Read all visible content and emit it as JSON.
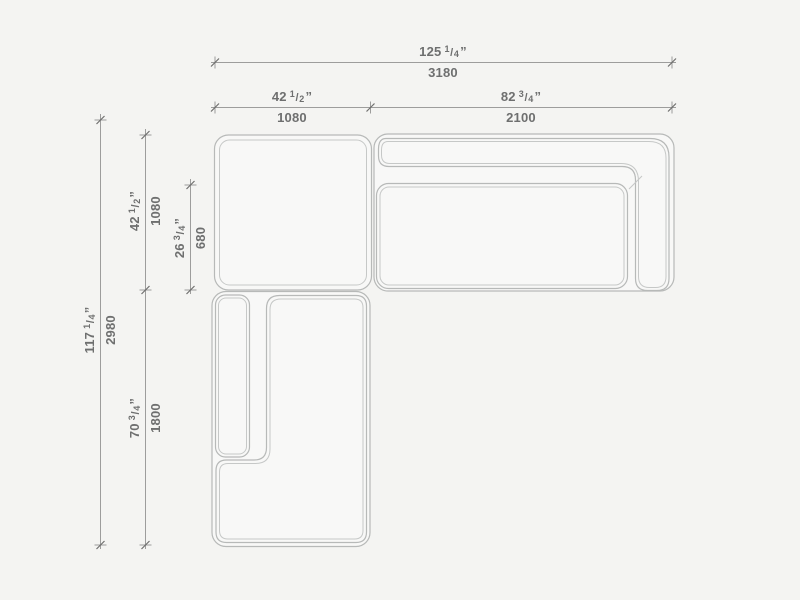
{
  "drawing": {
    "subject": "sectional-sofa-top-view-dimension-drawing",
    "palette": {
      "background": "#f4f4f2",
      "furniture_line": "#b7b9b8",
      "furniture_inner_line": "#c6c8c7",
      "dimension_line": "#9d9d9c",
      "tick_slash": "#6f6f6f",
      "text": "#6e6f6f"
    }
  },
  "dims": {
    "width_total": {
      "whole": "125",
      "num": "1",
      "den": "4",
      "unit": "”",
      "mm": "3180"
    },
    "width_left": {
      "whole": "42",
      "num": "1",
      "den": "2",
      "unit": "”",
      "mm": "1080"
    },
    "width_right": {
      "whole": "82",
      "num": "3",
      "den": "4",
      "unit": "”",
      "mm": "2100"
    },
    "height_total": {
      "whole": "117",
      "num": "1",
      "den": "4",
      "unit": "”",
      "mm": "2980"
    },
    "height_top": {
      "whole": "42",
      "num": "1",
      "den": "2",
      "unit": "”",
      "mm": "1080"
    },
    "seat_depth": {
      "whole": "26",
      "num": "3",
      "den": "4",
      "unit": "”",
      "mm": "680"
    },
    "height_bottom": {
      "whole": "70",
      "num": "3",
      "den": "4",
      "unit": "”",
      "mm": "1800"
    }
  }
}
